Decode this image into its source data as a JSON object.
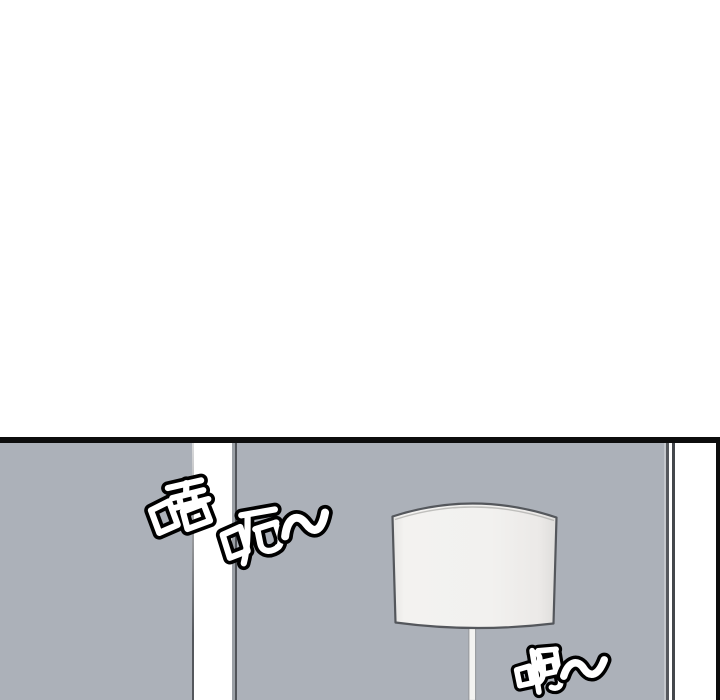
{
  "colors": {
    "page-bg": "#ffffff",
    "panel-border": "#0d0d0d",
    "wall": "#acb1b9",
    "gap": "#ffffff",
    "shade": "#f1f0ee",
    "shade-outline": "#54575c"
  },
  "panel": {
    "scene_objects": [
      "floor-lamp",
      "door-gap",
      "room-corner"
    ]
  },
  "sfx": [
    {
      "text": "唔"
    },
    {
      "text": "呃~"
    },
    {
      "text": "啊~"
    }
  ]
}
